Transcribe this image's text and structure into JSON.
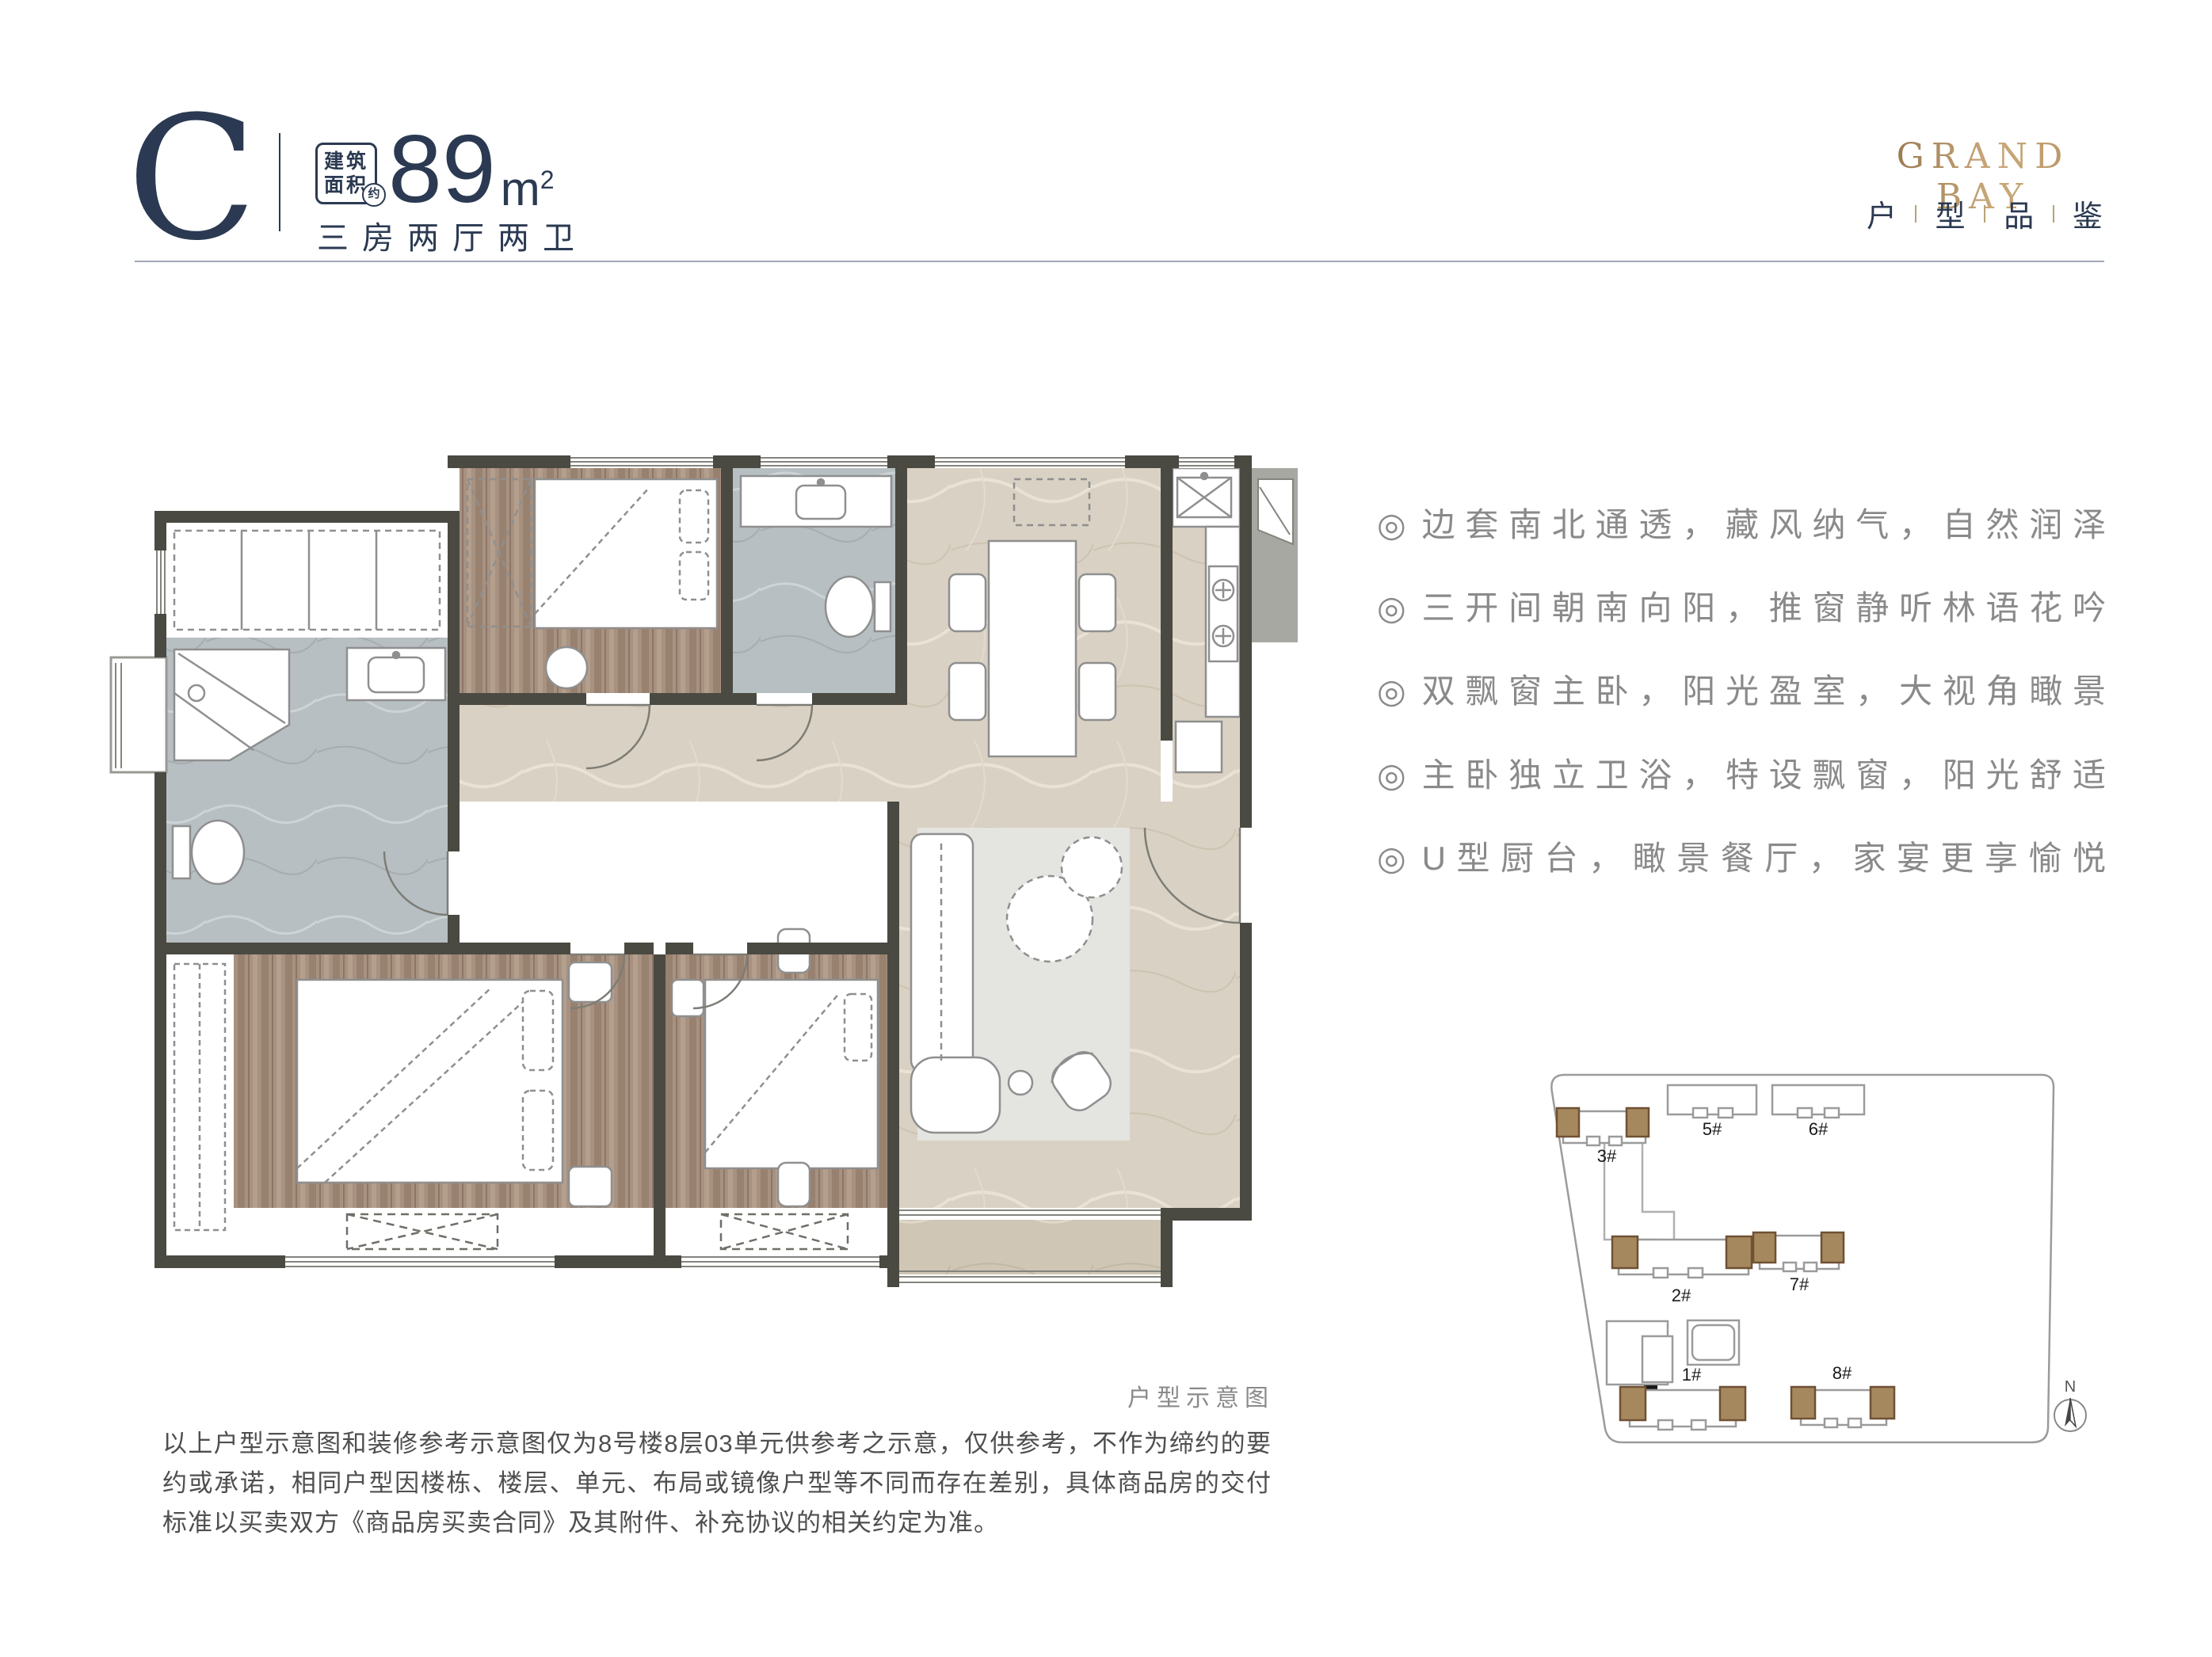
{
  "header": {
    "plan_letter": "C",
    "badge": [
      "建筑",
      "面积"
    ],
    "badge_approx": "约",
    "area_value": "89",
    "area_unit": "m",
    "area_unit_sup": "2",
    "layout_text": "三房两厅两卫"
  },
  "brand": {
    "name": "GRAND BAY",
    "tagline_chars": [
      "户",
      "型",
      "品",
      "鉴"
    ]
  },
  "features": {
    "bullet": "◎",
    "items": [
      "边套南北通透，藏风纳气，自然润泽",
      "三开间朝南向阳，推窗静听林语花吟",
      "双飘窗主卧，阳光盈室，大视角瞰景",
      "主卧独立卫浴，特设飘窗，阳光舒适",
      "U型厨台，瞰景餐厅，家宴更享愉悦"
    ]
  },
  "floor_plan": {
    "caption": "户型示意图"
  },
  "site_plan": {
    "buildings": [
      "1#",
      "2#",
      "3#",
      "5#",
      "6#",
      "7#",
      "8#"
    ],
    "north_label": "N"
  },
  "disclaimer": "以上户型示意图和装修参考示意图仅为8号楼8层03单元供参考之示意，仅供参考，不作为缔约的要约或承诺，相同户型因楼栋、楼层、单元、布局或镜像户型等不同而存在差别，具体商品房的交付标准以买卖双方《商品房买卖合同》及其附件、补充协议的相关约定为准。",
  "colors": {
    "navy": "#2b3a52",
    "gold": "#b3905f",
    "feature_gray": "#8a8a8a",
    "disclaimer_gray": "#4f4f4f",
    "wall_dark": "#4a4a42",
    "wall_gray": "#9a9a94",
    "wood_floor": "#a79181",
    "marble_beige": "#d9d1c3",
    "bath_marble": "#b7bfc2",
    "rug": "#e4e4e1",
    "site_highlight_brown": "#a6885f",
    "rule_line": "#a0a8ba"
  }
}
